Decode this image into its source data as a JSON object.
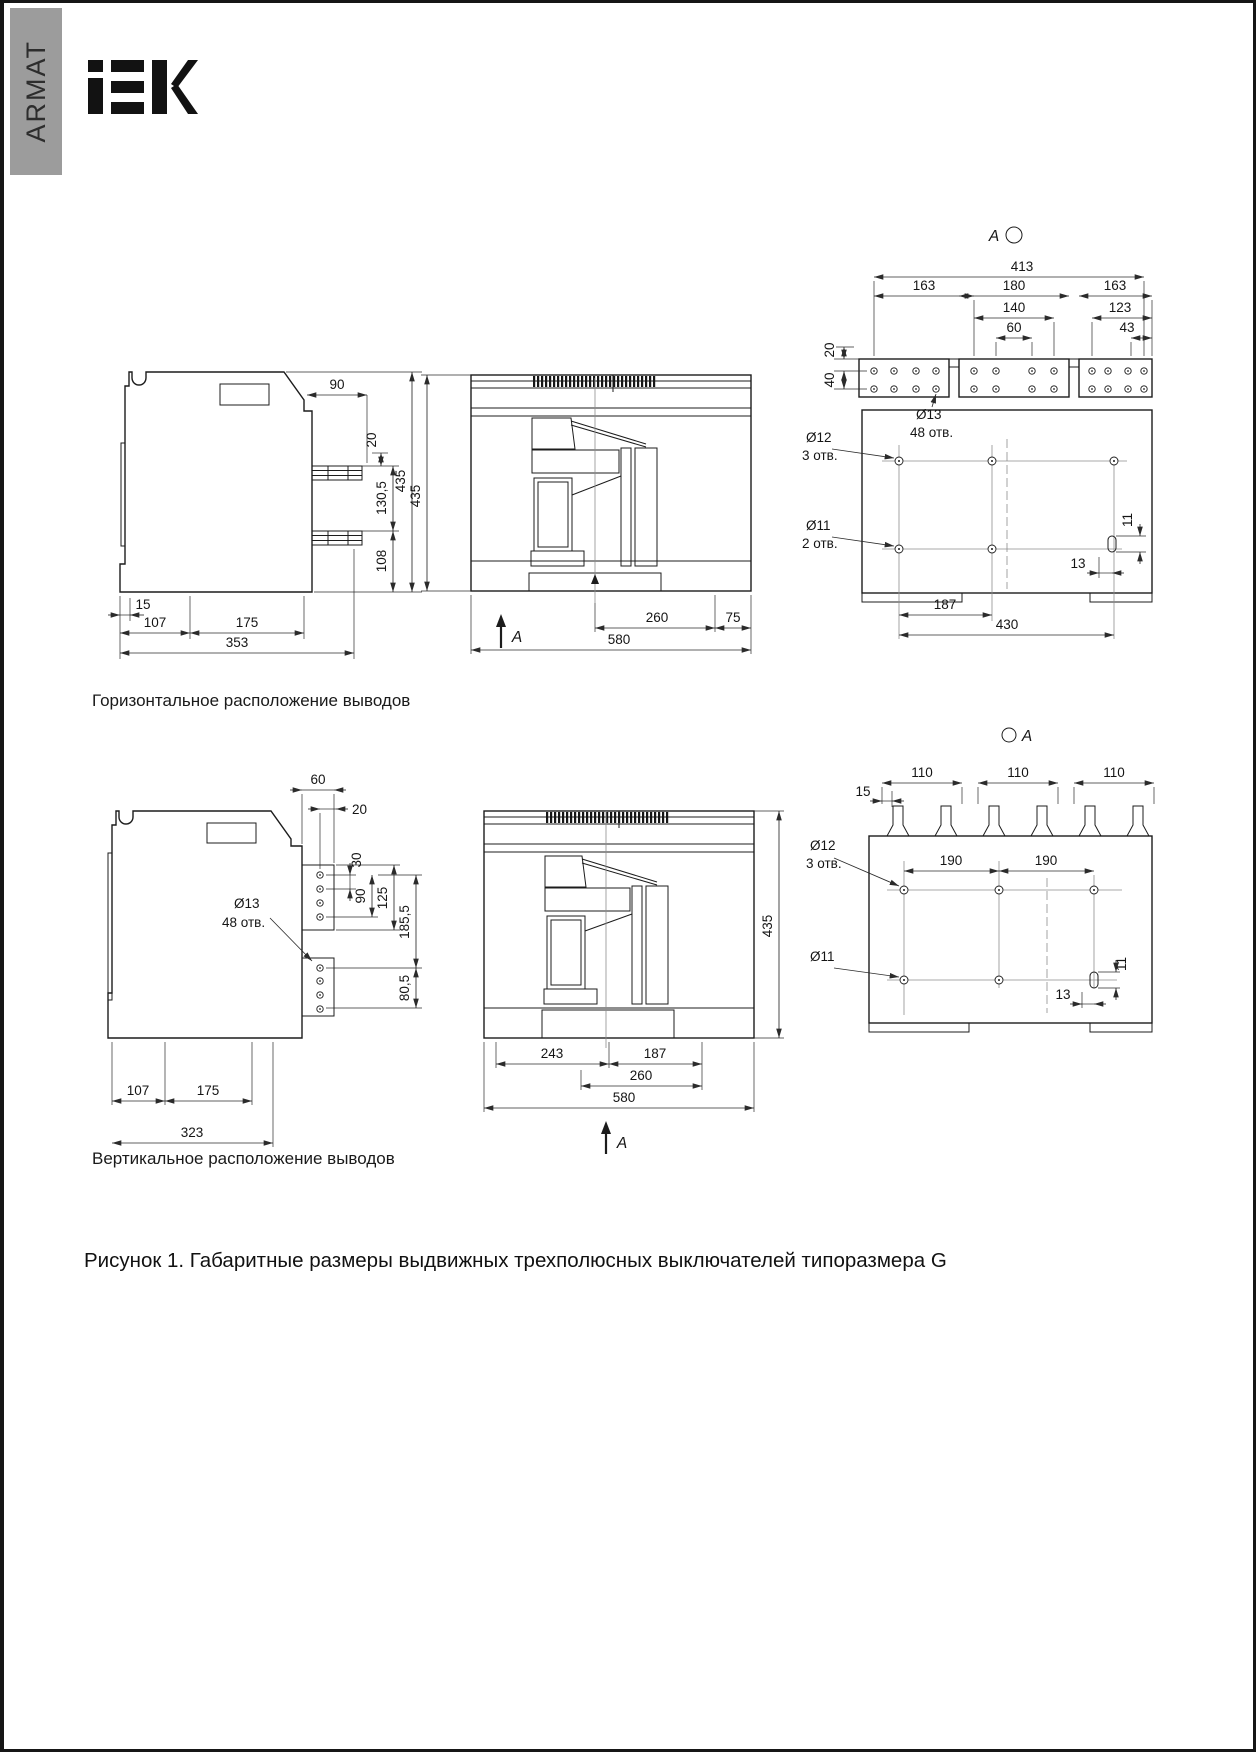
{
  "colors": {
    "paper": "#ffffff",
    "sidebar": "#9c9c9c",
    "logo": "#121212",
    "line": "#1c1c1c",
    "dim": "#2b2b2b",
    "center": "#8d8d8d"
  },
  "header": {
    "side_label": "ARMAT",
    "logo_text": "IEK"
  },
  "sections": {
    "horizontal": {
      "label": "Горизонтальное расположение выводов"
    },
    "vertical": {
      "label": "Вертикальное расположение выводов"
    }
  },
  "views": {
    "h_side": {
      "d90": "90",
      "d20": "20",
      "d130_5": "130,5",
      "d108": "108",
      "d435": "435",
      "d15": "15",
      "d107": "107",
      "d175": "175",
      "d353": "353"
    },
    "h_front": {
      "d435": "435",
      "d260": "260",
      "d75": "75",
      "d580": "580",
      "section": "A"
    },
    "h_rear": {
      "view": "A",
      "d413": "413",
      "d163_l": "163",
      "d180": "180",
      "d140": "140",
      "d60": "60",
      "d163_r": "163",
      "d123": "123",
      "d43": "43",
      "d20": "20",
      "d40": "40",
      "hole_13": "Ø13",
      "hole_13_count": "48 отв.",
      "hole_12": "Ø12",
      "hole_12_count": "3 отв.",
      "hole_11": "Ø11",
      "hole_11_count": "2 отв.",
      "d11": "11",
      "d13": "13",
      "d187": "187",
      "d430": "430"
    },
    "v_side": {
      "d60": "60",
      "d20": "20",
      "d30": "30",
      "d90": "90",
      "d125": "125",
      "hole_13": "Ø13",
      "hole_13_count": "48 отв.",
      "d185_5": "185,5",
      "d80_5": "80,5",
      "d107": "107",
      "d175": "175",
      "d323": "323"
    },
    "v_front": {
      "d435": "435",
      "d243": "243",
      "d187": "187",
      "d260": "260",
      "d580": "580",
      "section": "A"
    },
    "v_rear": {
      "view": "A",
      "d110_1": "110",
      "d110_2": "110",
      "d110_3": "110",
      "d15": "15",
      "hole_12": "Ø12",
      "hole_12_count": "3 отв.",
      "d190_1": "190",
      "d190_2": "190",
      "hole_11": "Ø11",
      "d13": "13",
      "d11": "11"
    }
  },
  "caption": "Рисунок 1. Габаритные размеры выдвижных трехполюсных выключателей типоразмера G"
}
